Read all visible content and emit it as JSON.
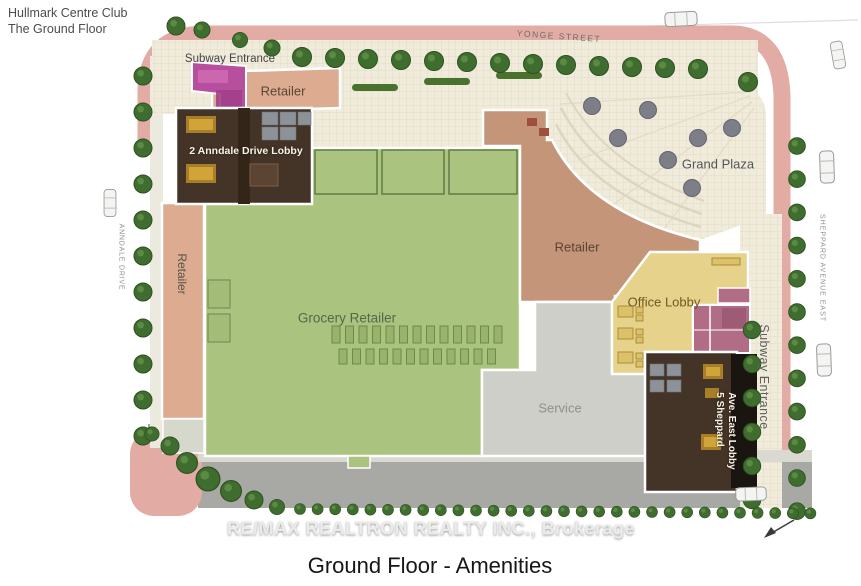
{
  "page": {
    "title_line1": "Hullmark Centre Club",
    "title_line2": "The Ground Floor",
    "caption": "Ground Floor - Amenities",
    "watermark": "RE/MAX REALTRON REALTY INC., Brokerage"
  },
  "streets": {
    "top": "YONGE STREET",
    "left": "ANNDALE DRIVE",
    "right": "SHEPPARD AVENUE EAST"
  },
  "areas": {
    "subway_entrance_nw": "Subway Entrance",
    "retailer_top": "Retailer",
    "anndale_lobby": "2 Anndale Drive Lobby",
    "retailer_left": "Retailer",
    "grocery": "Grocery Retailer",
    "retailer_center": "Retailer",
    "grand_plaza": "Grand Plaza",
    "office_lobby": "Office Lobby",
    "service": "Service",
    "sheppard_lobby_line1": "5 Sheppard",
    "sheppard_lobby_line2": "Ave. East Lobby",
    "subway_entrance_east": "Subway Entrance"
  },
  "colors": {
    "grocery": "#aac37f",
    "retailer_strip": "#dcab90",
    "retailer_center": "#c49579",
    "office_lobby": "#e7d28c",
    "service": "#cdcfc8",
    "lobby_dark": "#443428",
    "subway_structure": "#b74f9e",
    "mauve_rooms": "#b06d85",
    "sidewalk_pink": "#e2aca4",
    "paving_cream": "#f0ebdb",
    "road_gray": "#a8a9a4",
    "tree_green": "#3f6d2f",
    "plaza_planter": "#7e7e88"
  }
}
